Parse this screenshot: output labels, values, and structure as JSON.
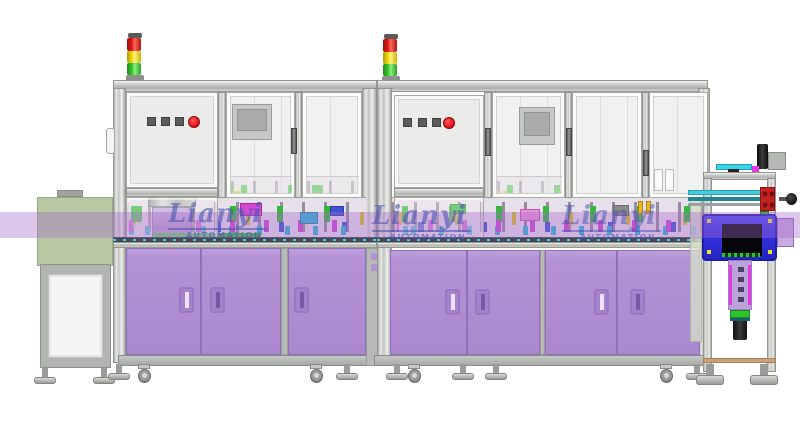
{
  "watermarks": [
    {
      "brand": "Lianyi",
      "subtitle": "AUTOMATION"
    },
    {
      "brand": "Lianyi",
      "subtitle": "AUTOMATION"
    },
    {
      "brand": "Lianyi",
      "subtitle": "AUTOMATION"
    }
  ],
  "signal_tower": {
    "segments_top_to_bottom": [
      "red",
      "yellow",
      "green"
    ]
  },
  "control_panel": {
    "square_buttons_count": 3,
    "round_buttons_count": 1
  },
  "stations": {
    "enclosed_machines": 2,
    "infeed_conveyor_units": 1,
    "outfeed_handling_units": 1
  },
  "colors": {
    "emergency_red": "#e81420",
    "signal_red": "#e01818",
    "signal_yellow": "#f0d908",
    "signal_green": "#35c32c",
    "cabinet": "#b292d4",
    "handle_slot_light": "#f0e2fa",
    "handle_slot_dark": "#7b57a8",
    "green_cover": "#7c9c58",
    "blue_housing": "#3535e6",
    "arm_lilac": "#bca4da",
    "accent_magenta": "#e23ae2",
    "accent_cyan": "#38d4e4",
    "accent_green": "#2ec22e",
    "watermark_blue": "#4752b0",
    "band_purple": "#a56aca"
  }
}
